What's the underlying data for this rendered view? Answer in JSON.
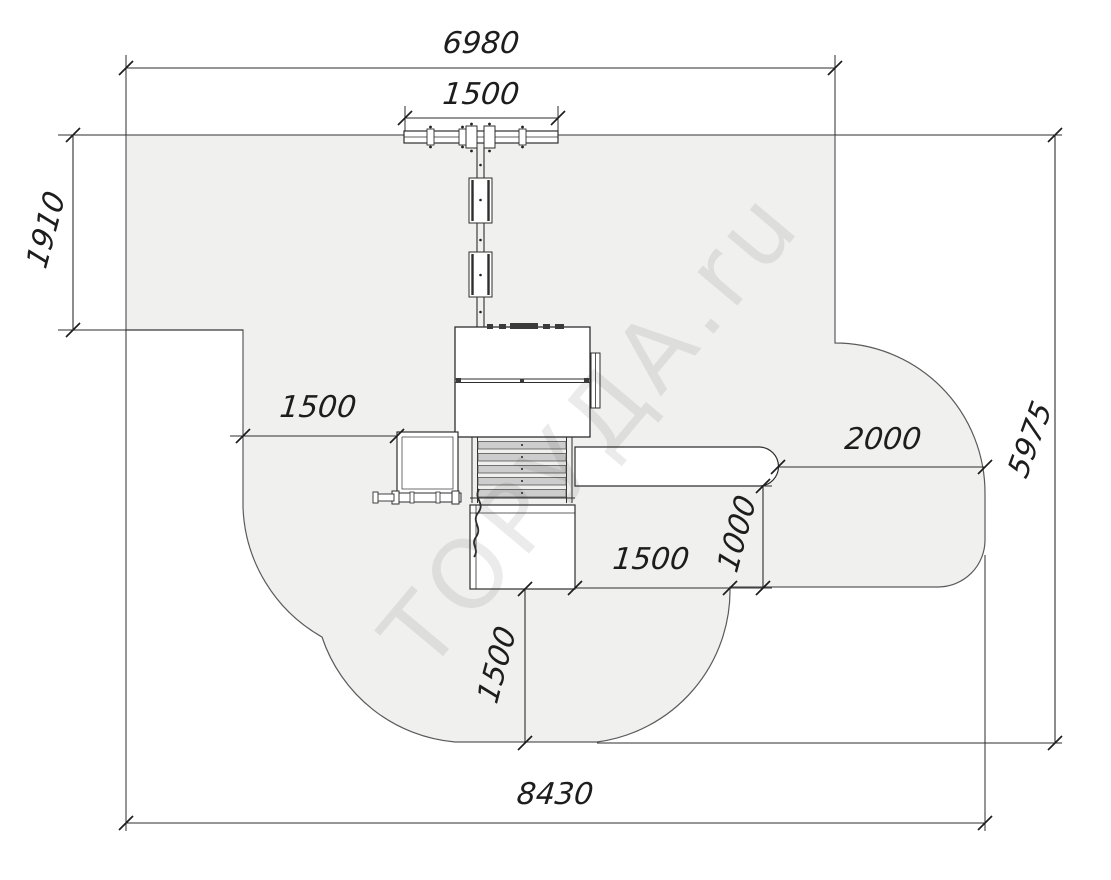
{
  "drawing": {
    "title": "Playground equipment plan with safety zone",
    "watermark": "ТОРУДА.ru",
    "units": "mm"
  },
  "dims": {
    "top_width": "6980",
    "swing_beam": "1500",
    "left_depth": "1910",
    "left_clearance": "1500",
    "slide_clearance": "2000",
    "zone_height": "5975",
    "slide_depth": "1000",
    "platform_clearance": "1500",
    "bottom_clearance": "1500",
    "total_width": "8430"
  },
  "colors": {
    "zone_fill": "#f0f0ef",
    "zone_border": "#5a5a5a",
    "line": "#2e2e2e",
    "dim_text": "#1d1d1d"
  }
}
